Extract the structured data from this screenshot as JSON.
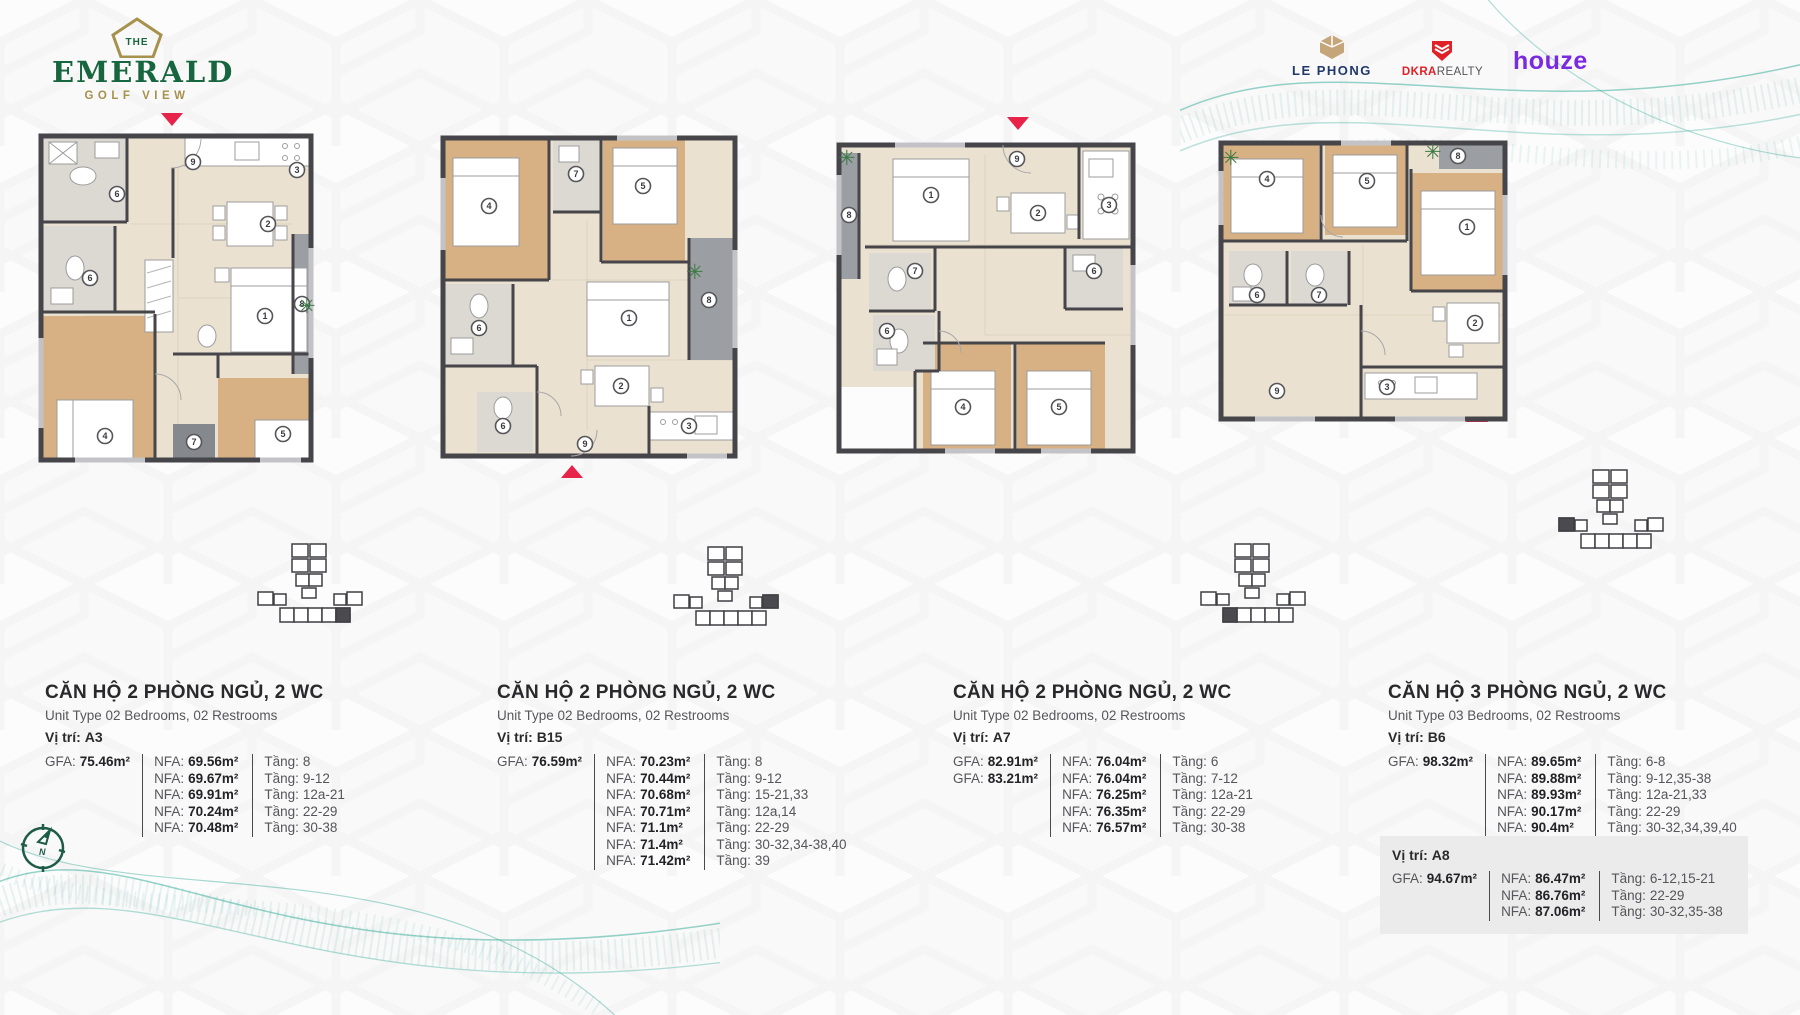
{
  "brand": {
    "the": "THE",
    "name": "EMERALD",
    "tagline": "GOLF VIEW"
  },
  "partners": {
    "lephong": "LE PHONG",
    "dkra_bold": "DKRA",
    "dkra_rest": "REALTY",
    "houze": "houze"
  },
  "labels": {
    "gfa": "GFA:",
    "nfa": "NFA:",
    "floor": "Tầng:",
    "location": "Vị trí:"
  },
  "compass": {
    "n": "N"
  },
  "units": [
    {
      "title": "CĂN HỘ 2 PHÒNG NGỦ, 2 WC",
      "subtitle": "Unit Type 02 Bedrooms, 02 Restrooms",
      "location": "A3",
      "gfa": [
        "75.46m²"
      ],
      "rows": [
        {
          "nfa": "69.56m²",
          "floor": "8"
        },
        {
          "nfa": "69.67m²",
          "floor": "9-12"
        },
        {
          "nfa": "69.91m²",
          "floor": "12a-21"
        },
        {
          "nfa": "70.24m²",
          "floor": "22-29"
        },
        {
          "nfa": "70.48m²",
          "floor": "30-38"
        }
      ],
      "markers": [
        "9",
        "3",
        "2",
        "6",
        "6",
        "1",
        "8",
        "4",
        "5",
        "7"
      ]
    },
    {
      "title": "CĂN HỘ 2 PHÒNG NGỦ, 2 WC",
      "subtitle": "Unit Type 02 Bedrooms, 02 Restrooms",
      "location": "B15",
      "gfa": [
        "76.59m²"
      ],
      "rows": [
        {
          "nfa": "70.23m²",
          "floor": "8"
        },
        {
          "nfa": "70.44m²",
          "floor": "9-12"
        },
        {
          "nfa": "70.68m²",
          "floor": "15-21,33"
        },
        {
          "nfa": "70.71m²",
          "floor": "12a,14"
        },
        {
          "nfa": "71.1m²",
          "floor": "22-29"
        },
        {
          "nfa": "71.4m²",
          "floor": "30-32,34-38,40"
        },
        {
          "nfa": "71.42m²",
          "floor": "39"
        }
      ],
      "markers": [
        "4",
        "7",
        "5",
        "8",
        "6",
        "1",
        "2",
        "3",
        "6",
        "9"
      ]
    },
    {
      "title": "CĂN HỘ 2 PHÒNG NGỦ, 2 WC",
      "subtitle": "Unit Type 02 Bedrooms, 02 Restrooms",
      "location": "A7",
      "gfa": [
        "82.91m²",
        "83.21m²"
      ],
      "rows": [
        {
          "nfa": "76.04m²",
          "floor": "6"
        },
        {
          "nfa": "76.04m²",
          "floor": "7-12"
        },
        {
          "nfa": "76.25m²",
          "floor": "12a-21"
        },
        {
          "nfa": "76.35m²",
          "floor": "22-29"
        },
        {
          "nfa": "76.57m²",
          "floor": "30-38"
        }
      ],
      "markers": [
        "8",
        "1",
        "9",
        "2",
        "3",
        "7",
        "6",
        "6",
        "4",
        "5"
      ]
    },
    {
      "title": "CĂN HỘ 3 PHÒNG NGỦ, 2 WC",
      "subtitle": "Unit Type 03 Bedrooms, 02 Restrooms",
      "location": "B6",
      "gfa": [
        "98.32m²"
      ],
      "rows": [
        {
          "nfa": "89.65m²",
          "floor": "6-8"
        },
        {
          "nfa": "89.88m²",
          "floor": "9-12,35-38"
        },
        {
          "nfa": "89.93m²",
          "floor": "12a-21,33"
        },
        {
          "nfa": "90.17m²",
          "floor": "22-29"
        },
        {
          "nfa": "90.4m²",
          "floor": "30-32,34,39,40"
        }
      ],
      "markers": [
        "4",
        "5",
        "8",
        "1",
        "6",
        "7",
        "2",
        "3",
        "9"
      ],
      "extra": {
        "location": "A8",
        "gfa": [
          "94.67m²"
        ],
        "rows": [
          {
            "nfa": "86.47m²",
            "floor": "6-12,15-21"
          },
          {
            "nfa": "86.76m²",
            "floor": "22-29"
          },
          {
            "nfa": "87.06m²",
            "floor": "30-32,35-38"
          }
        ]
      }
    }
  ]
}
